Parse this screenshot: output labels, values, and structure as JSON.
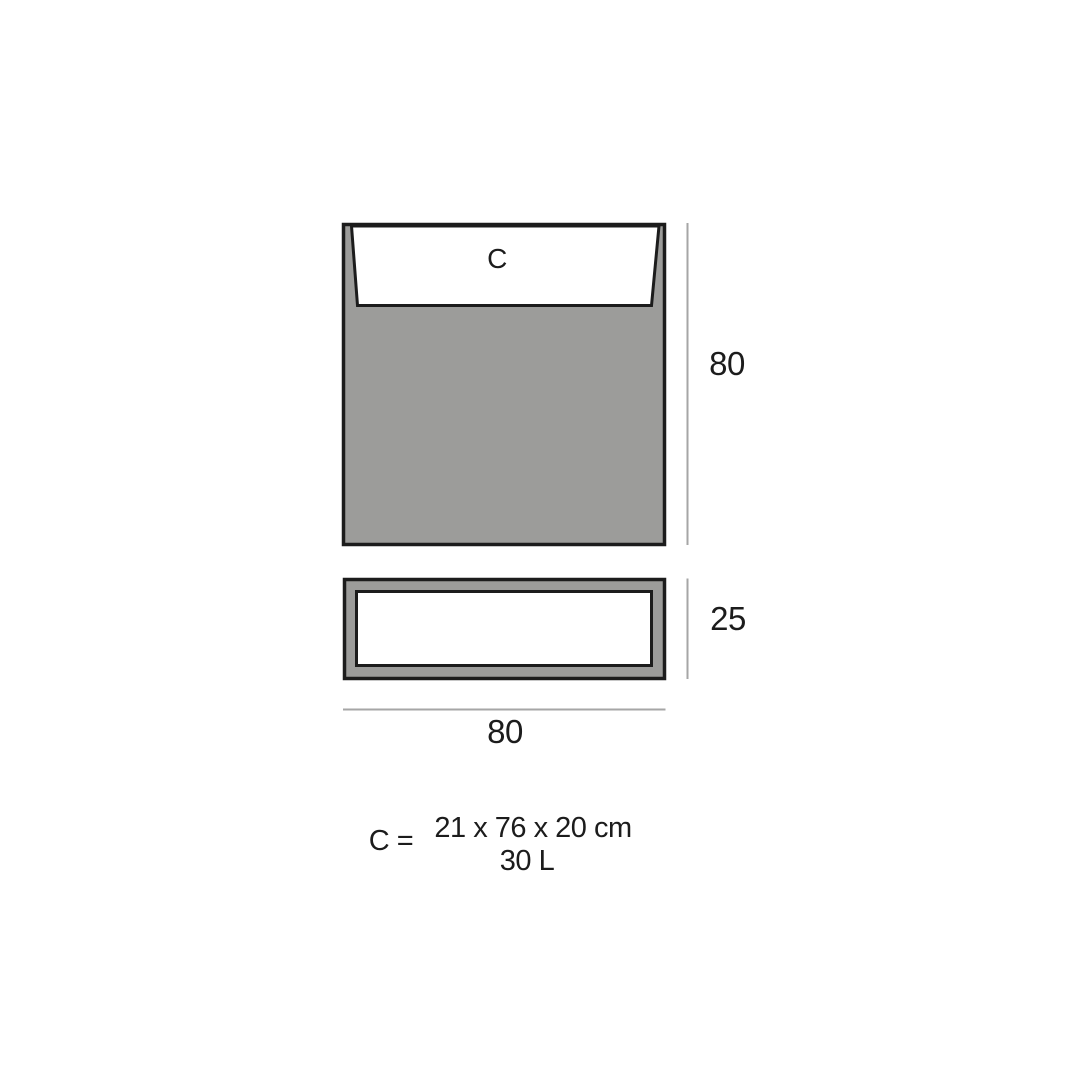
{
  "front_view": {
    "label": "C",
    "height_label": "80"
  },
  "top_view": {
    "height_label": "25"
  },
  "width_label": "80",
  "spec": {
    "key": "C =",
    "dimensions": "21 x 76 x 20 cm",
    "volume": "30 L"
  },
  "colors": {
    "body_gray": "#9c9c9a",
    "cavity_white": "#ffffff",
    "outline": "#1c1c1c",
    "dim_line": "#a6a6a6",
    "text": "#1c1c1c",
    "background": "#ffffff"
  }
}
